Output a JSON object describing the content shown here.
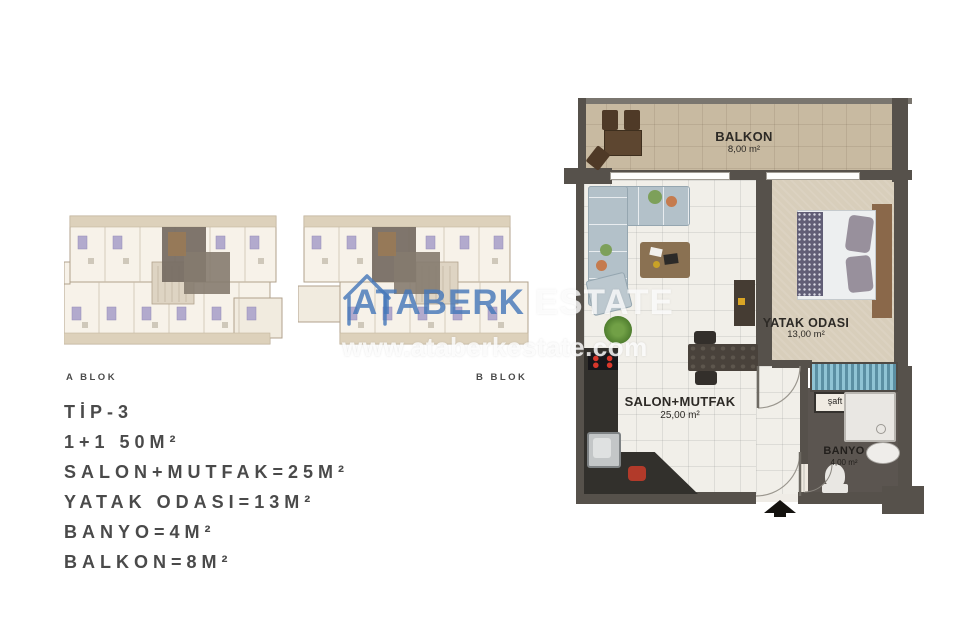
{
  "page": {
    "background": "#ffffff"
  },
  "site_plans": {
    "a": {
      "label": "A BLOK"
    },
    "b": {
      "label": "B BLOK"
    },
    "highlight_color": "#756c62"
  },
  "specs": {
    "title": "TİP-3",
    "lines": [
      "1+1 50M²",
      "SALON+MUTFAK=25M²",
      "YATAK ODASI=13M²",
      "BANYO=4M²",
      "BALKON=8M²"
    ]
  },
  "watermark": {
    "brand": "ATABERK",
    "brand_suffix": "ESTATE",
    "url": "www.ataberkestate.com",
    "brand_color": "#4a7cb8"
  },
  "plan": {
    "rooms": [
      {
        "name": "BALKON",
        "area": "8,00 m²"
      },
      {
        "name": "YATAK ODASI",
        "area": "13,00 m²"
      },
      {
        "name": "SALON+MUTFAK",
        "area": "25,00 m²"
      },
      {
        "name": "BANYO",
        "area": "4,00 m²"
      }
    ],
    "shaft_label": "şaft",
    "colors": {
      "wall": "#56514b",
      "balcony_floor": "#c8baa1",
      "salon_floor": "#f1efe9",
      "bedroom_floor": "#d8cebb",
      "bathroom_floor": "#5b5550",
      "wardrobe": "#7fb5c9",
      "sofa": "#b3c1c9",
      "bed_headboard": "#8a684a"
    }
  }
}
